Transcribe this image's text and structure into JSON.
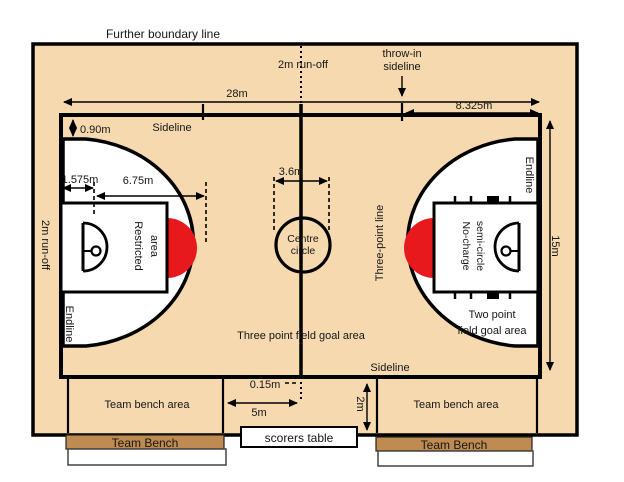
{
  "colors": {
    "court": "#f6d9ae",
    "red": "#e8191d",
    "bench": "#bf8b51",
    "line": "#000000"
  },
  "labels": {
    "further_boundary": "Further boundary line",
    "run_off_top": "2m run-off",
    "run_off_left": "2m run-off",
    "throw_in_line1": "throw-in",
    "throw_in_line2": "sideline",
    "sideline_top": "Sideline",
    "sideline_bottom": "Sideline",
    "endline_left": "Endline",
    "endline_right": "Endline",
    "three_point_line": "Three-point line",
    "centre_circle_line1": "Centre",
    "centre_circle_line2": "circle",
    "restricted_line1": "Restricted",
    "restricted_line2": "area",
    "no_charge_line1": "No-charge",
    "no_charge_line2": "semi-circle",
    "three_point_area": "Three point field goal area",
    "two_point_line1": "Two point",
    "two_point_line2": "field goal area",
    "team_bench_area_left": "Team bench area",
    "team_bench_area_right": "Team bench area",
    "team_bench_left": "Team Bench",
    "team_bench_right": "Team Bench",
    "scorers_table": "scorers table"
  },
  "dimensions": {
    "court_length": "28m",
    "throw_in_distance": "8.325m",
    "three_point_offset": "0.90m",
    "basket_offset": "1.575m",
    "three_point_radius": "6.75m",
    "centre_square": "3.6m",
    "court_width": "15m",
    "scorers_offset": "5m",
    "bench_depth": "2m",
    "centre_mark": "0.15m"
  }
}
